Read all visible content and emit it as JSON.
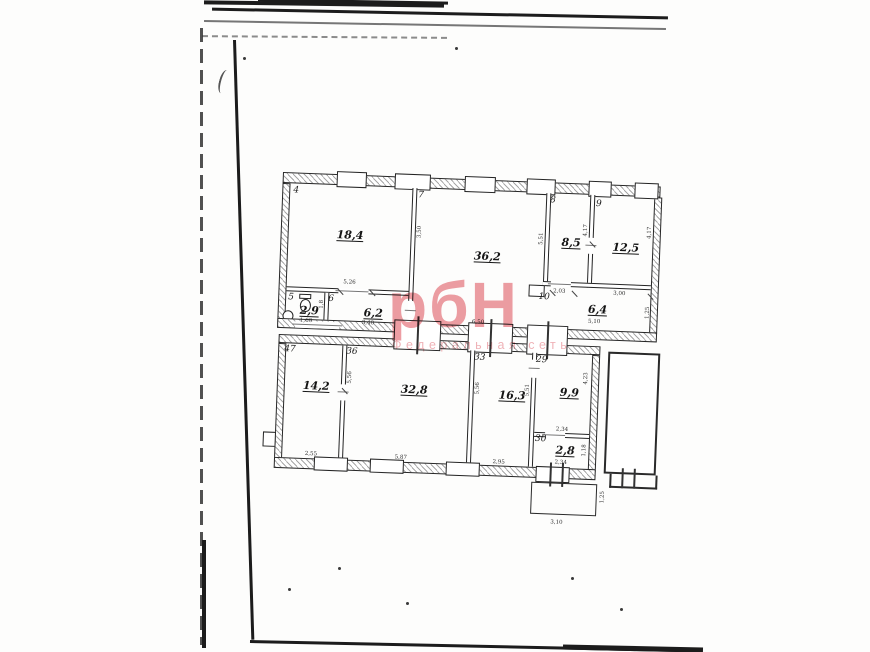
{
  "watermark": {
    "logo": "рбН",
    "subtitle": "Федеральная сеть",
    "logo_color": "rgba(222,77,88,0.55)",
    "subtitle_color": "rgba(233,152,159,0.75)"
  },
  "rooms": {
    "r4": {
      "number": "4",
      "area": "18,4"
    },
    "r5": {
      "number": "5",
      "area": "2,9"
    },
    "r6": {
      "number": "6",
      "area": "6,2"
    },
    "r7": {
      "number": "7",
      "area": "36,2"
    },
    "r8": {
      "number": "8",
      "area": "8,5"
    },
    "r9": {
      "number": "9",
      "area": "12,5"
    },
    "r10": {
      "number": "10",
      "area": "6,4"
    },
    "r47": {
      "number": "47",
      "area": "14,2"
    },
    "r36": {
      "number": "36",
      "area": "32,8"
    },
    "r33": {
      "number": "33",
      "area": "16,3"
    },
    "r29": {
      "number": "29",
      "area": "9,9"
    },
    "r30": {
      "number": "30",
      "area": "2,8"
    }
  },
  "dims": {
    "w526": "5,26",
    "w160": "1,60",
    "w340": "3,40",
    "w203": "2,03",
    "w300": "3,00",
    "w510": "5,10",
    "w650": "6,50",
    "w255": "2,55",
    "w587": "5,87",
    "w295": "2,95",
    "w234t": "2,34",
    "w234b": "2,34",
    "w310": "3,10",
    "v350": "3,50",
    "v551a": "5,51",
    "v417a": "4,17",
    "v417b": "4,17",
    "v556a": "5,56",
    "v556b": "5,56",
    "v551b": "5,51",
    "v423": "4,23",
    "v118": "1,18",
    "v125a": "1,25",
    "v125b": "1,25",
    "v18": "1,8"
  }
}
